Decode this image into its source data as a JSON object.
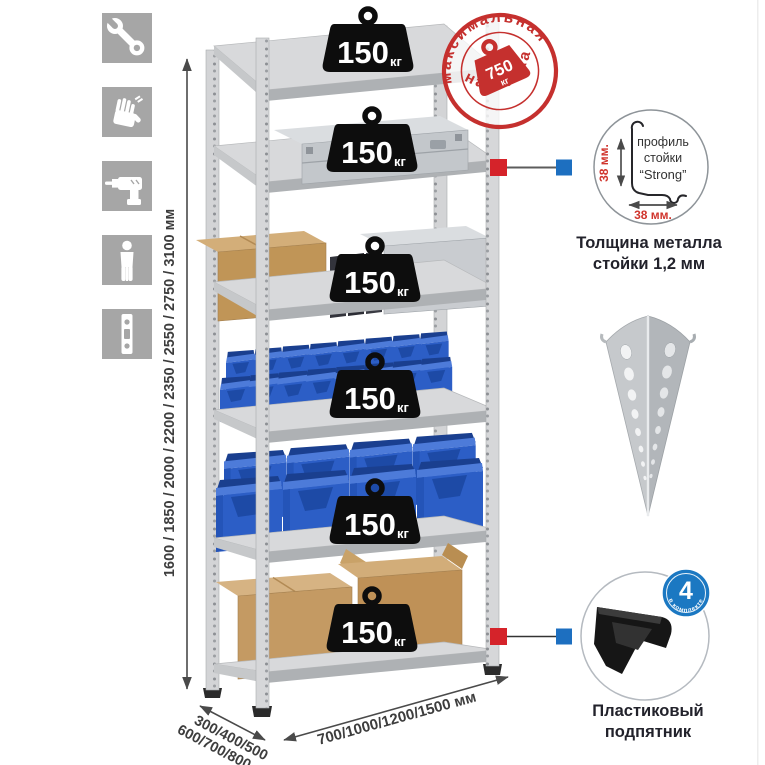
{
  "sidebar": {
    "icons": [
      {
        "name": "wrench-icon"
      },
      {
        "name": "gloves-icon"
      },
      {
        "name": "drill-icon"
      },
      {
        "name": "person-icon"
      },
      {
        "name": "perforated-post-icon"
      }
    ]
  },
  "dimensions": {
    "height": "1600 / 1850 / 2000 / 2200 / 2350 / 2550 / 2750 / 3100 мм",
    "depth_line1": "300/400/500",
    "depth_line2": "600/700/800 мм",
    "width": "700/1000/1200/1500 мм"
  },
  "shelf_load_badge": {
    "value": "150",
    "unit": "кг",
    "count": 6
  },
  "max_load_stamp": {
    "arc_top": "максимальная",
    "arc_bottom": "нагрузка",
    "value": "750",
    "unit": "кг"
  },
  "profile_callout": {
    "label_line1": "профиль",
    "label_line2": "стойки",
    "label_line3": "“Strong”",
    "vertical_dim": "38 мм.",
    "horizontal_dim": "38 мм.",
    "caption_line1": "Толщина металла",
    "caption_line2": "стойки 1,2 мм"
  },
  "foot_callout": {
    "badge_value": "4",
    "badge_arc_text": "в комплекте",
    "caption_line1": "Пластиковый",
    "caption_line2": "подпятник"
  },
  "colors": {
    "stamp_red": "#c5302e",
    "marker_red": "#d5232a",
    "marker_blue": "#1d6fc0",
    "badge_blue": "#1b78c2",
    "bin_blue": "#2e62c8",
    "icon_gray": "#a6a6a6",
    "dimension_text": "#3d3d3d"
  }
}
